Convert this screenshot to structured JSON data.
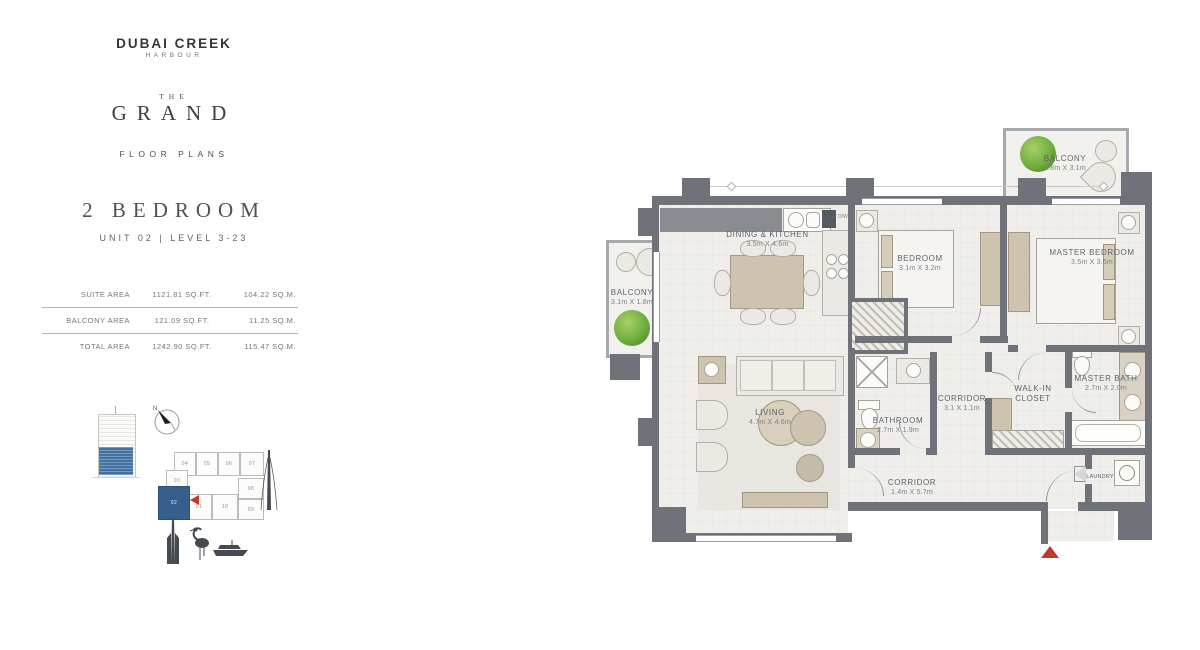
{
  "branding": {
    "name_line1": "DUBAI CREEK",
    "name_line2": "HARBOUR",
    "project_the": "THE",
    "project_name": "GRAND",
    "section": "FLOOR PLANS"
  },
  "unit": {
    "title": "2 BEDROOM",
    "subtitle": "UNIT 02 | LEVEL 3-23"
  },
  "area_table": {
    "rows": [
      {
        "label": "SUITE AREA",
        "sqft": "1121.81 SQ.FT.",
        "sqm": "104.22 SQ.M."
      },
      {
        "label": "BALCONY AREA",
        "sqft": "121.09 SQ.FT.",
        "sqm": "11.25 SQ.M."
      },
      {
        "label": "TOTAL AREA",
        "sqft": "1242.90 SQ.FT.",
        "sqm": "115.47 SQ.M."
      }
    ]
  },
  "keyplan": {
    "north_label": "N",
    "highlighted_unit": "02",
    "units": [
      "04",
      "05",
      "06",
      "07",
      "08",
      "09",
      "10",
      "01",
      "03",
      "02"
    ]
  },
  "plan": {
    "labels": {
      "dw": "D/W"
    },
    "rooms": {
      "balcony_tr": {
        "name": "BALCONY",
        "dims": "1.8m X 3.1m"
      },
      "dining": {
        "name": "DINING & KITCHEN",
        "dims": "3.5m X 4.6m"
      },
      "bedroom": {
        "name": "BEDROOM",
        "dims": "3.1m X 3.2m"
      },
      "master": {
        "name": "MASTER BEDROOM",
        "dims": "3.5m X 3.6m"
      },
      "balcony_l": {
        "name": "BALCONY",
        "dims": "3.1m X 1.8m"
      },
      "living": {
        "name": "LIVING",
        "dims": "4.7m X 4.6m"
      },
      "corridor1": {
        "name": "CORRIDOR",
        "dims": "3.1 X 1.1m"
      },
      "bathroom": {
        "name": "BATHROOM",
        "dims": "2.7m X 1.9m"
      },
      "walkin": {
        "name": "WALK-IN CLOSET"
      },
      "masterbath": {
        "name": "MASTER BATH",
        "dims": "2.7m X 2.0m"
      },
      "laundry": {
        "name": "LAUNDRY"
      },
      "corridor2": {
        "name": "CORRIDOR",
        "dims": "1.4m X 5.7m"
      }
    }
  },
  "colors": {
    "wall": "#6f7379",
    "floor": "#efeeea",
    "accent_red": "#c0392b",
    "keyplan_blue": "#4472a0",
    "plant_green": "#6fae3e",
    "furniture_beige": "#cdc3ae"
  }
}
